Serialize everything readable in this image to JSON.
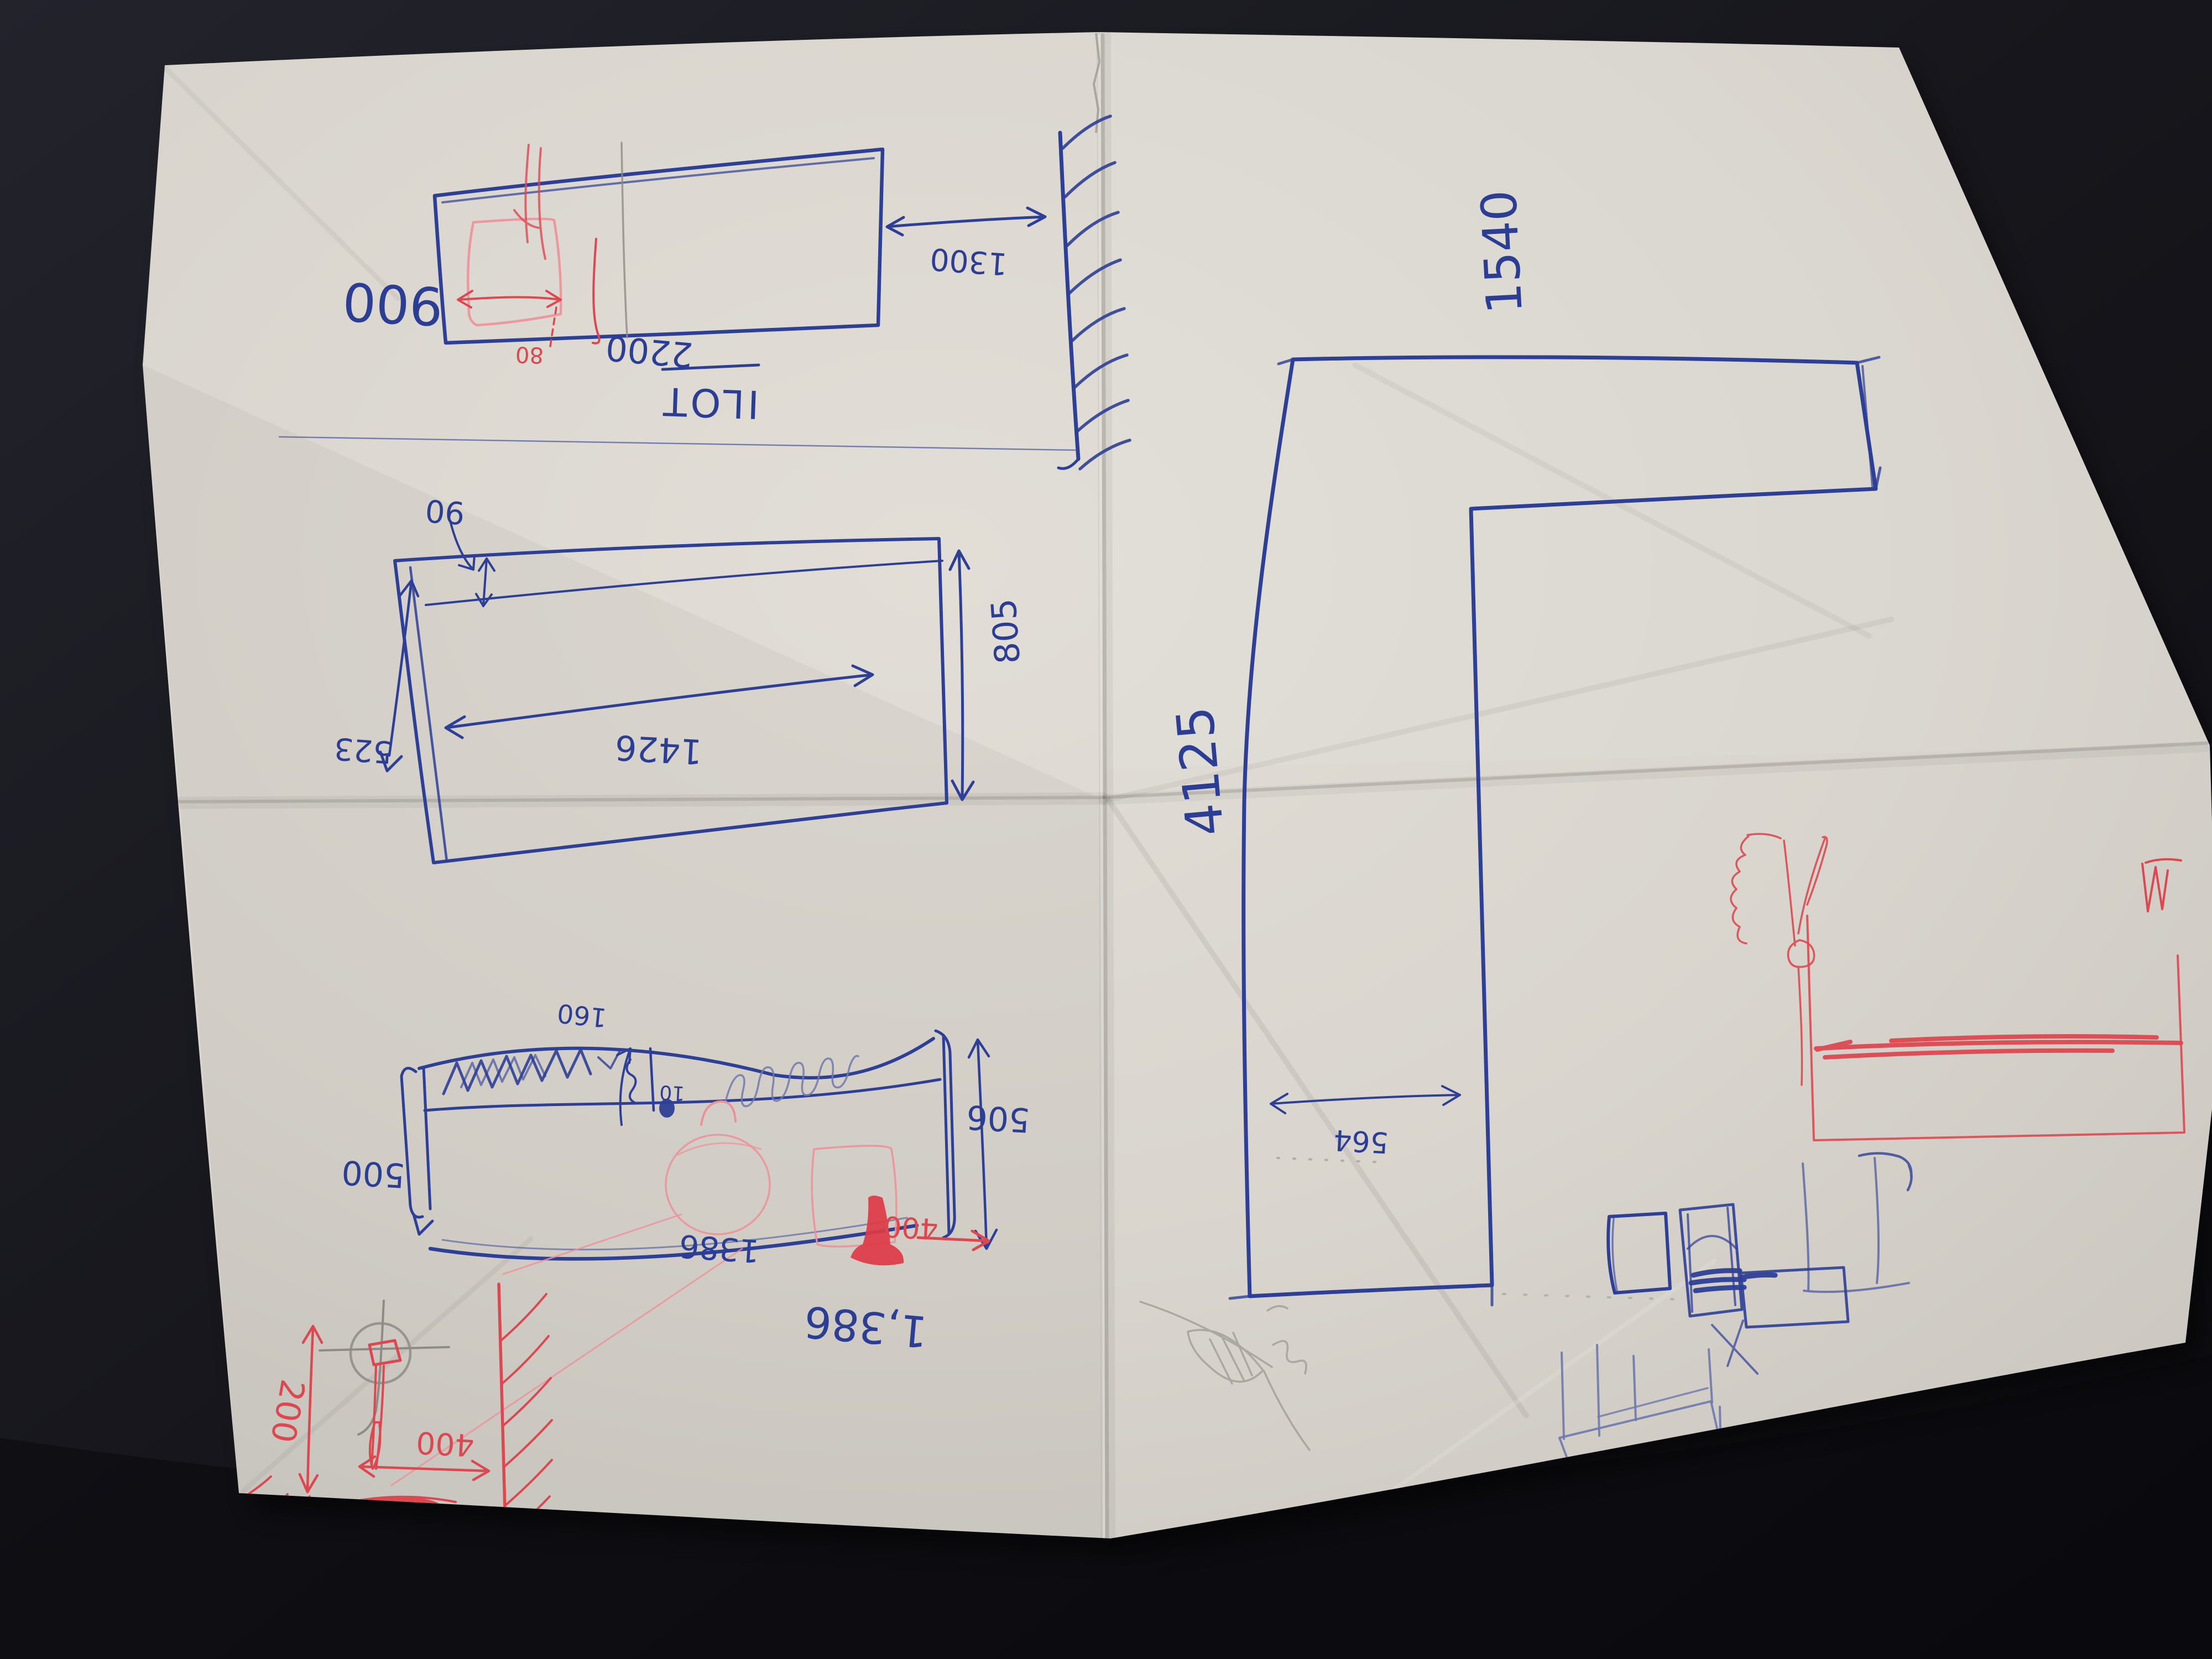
{
  "scene": {
    "labels": {
      "ilot": {
        "title": "ILOT",
        "depth": "900",
        "length": "2200",
        "wall_distance": "1300",
        "inset": "80"
      },
      "plan_detail": {
        "edge": "90",
        "inner_length": "1426",
        "depth": "805",
        "side": "523"
      },
      "elevation": {
        "left_height": "500",
        "right_height": "506",
        "upstand": "160",
        "small_dim": "10",
        "length": "1386",
        "length_note": "1,386",
        "red_offset": "400"
      },
      "corner_detail": {
        "height": "200",
        "wall_offset": "400"
      },
      "l_counter": {
        "top_run": "1540",
        "long_run": "4125",
        "arm_width": "564"
      }
    },
    "colors": {
      "ink_blue": "#2e3f96",
      "ink_red": "#dd4850",
      "pencil": "#8e8b85",
      "paper": "#d9d5ce",
      "background": "#17171c"
    }
  }
}
